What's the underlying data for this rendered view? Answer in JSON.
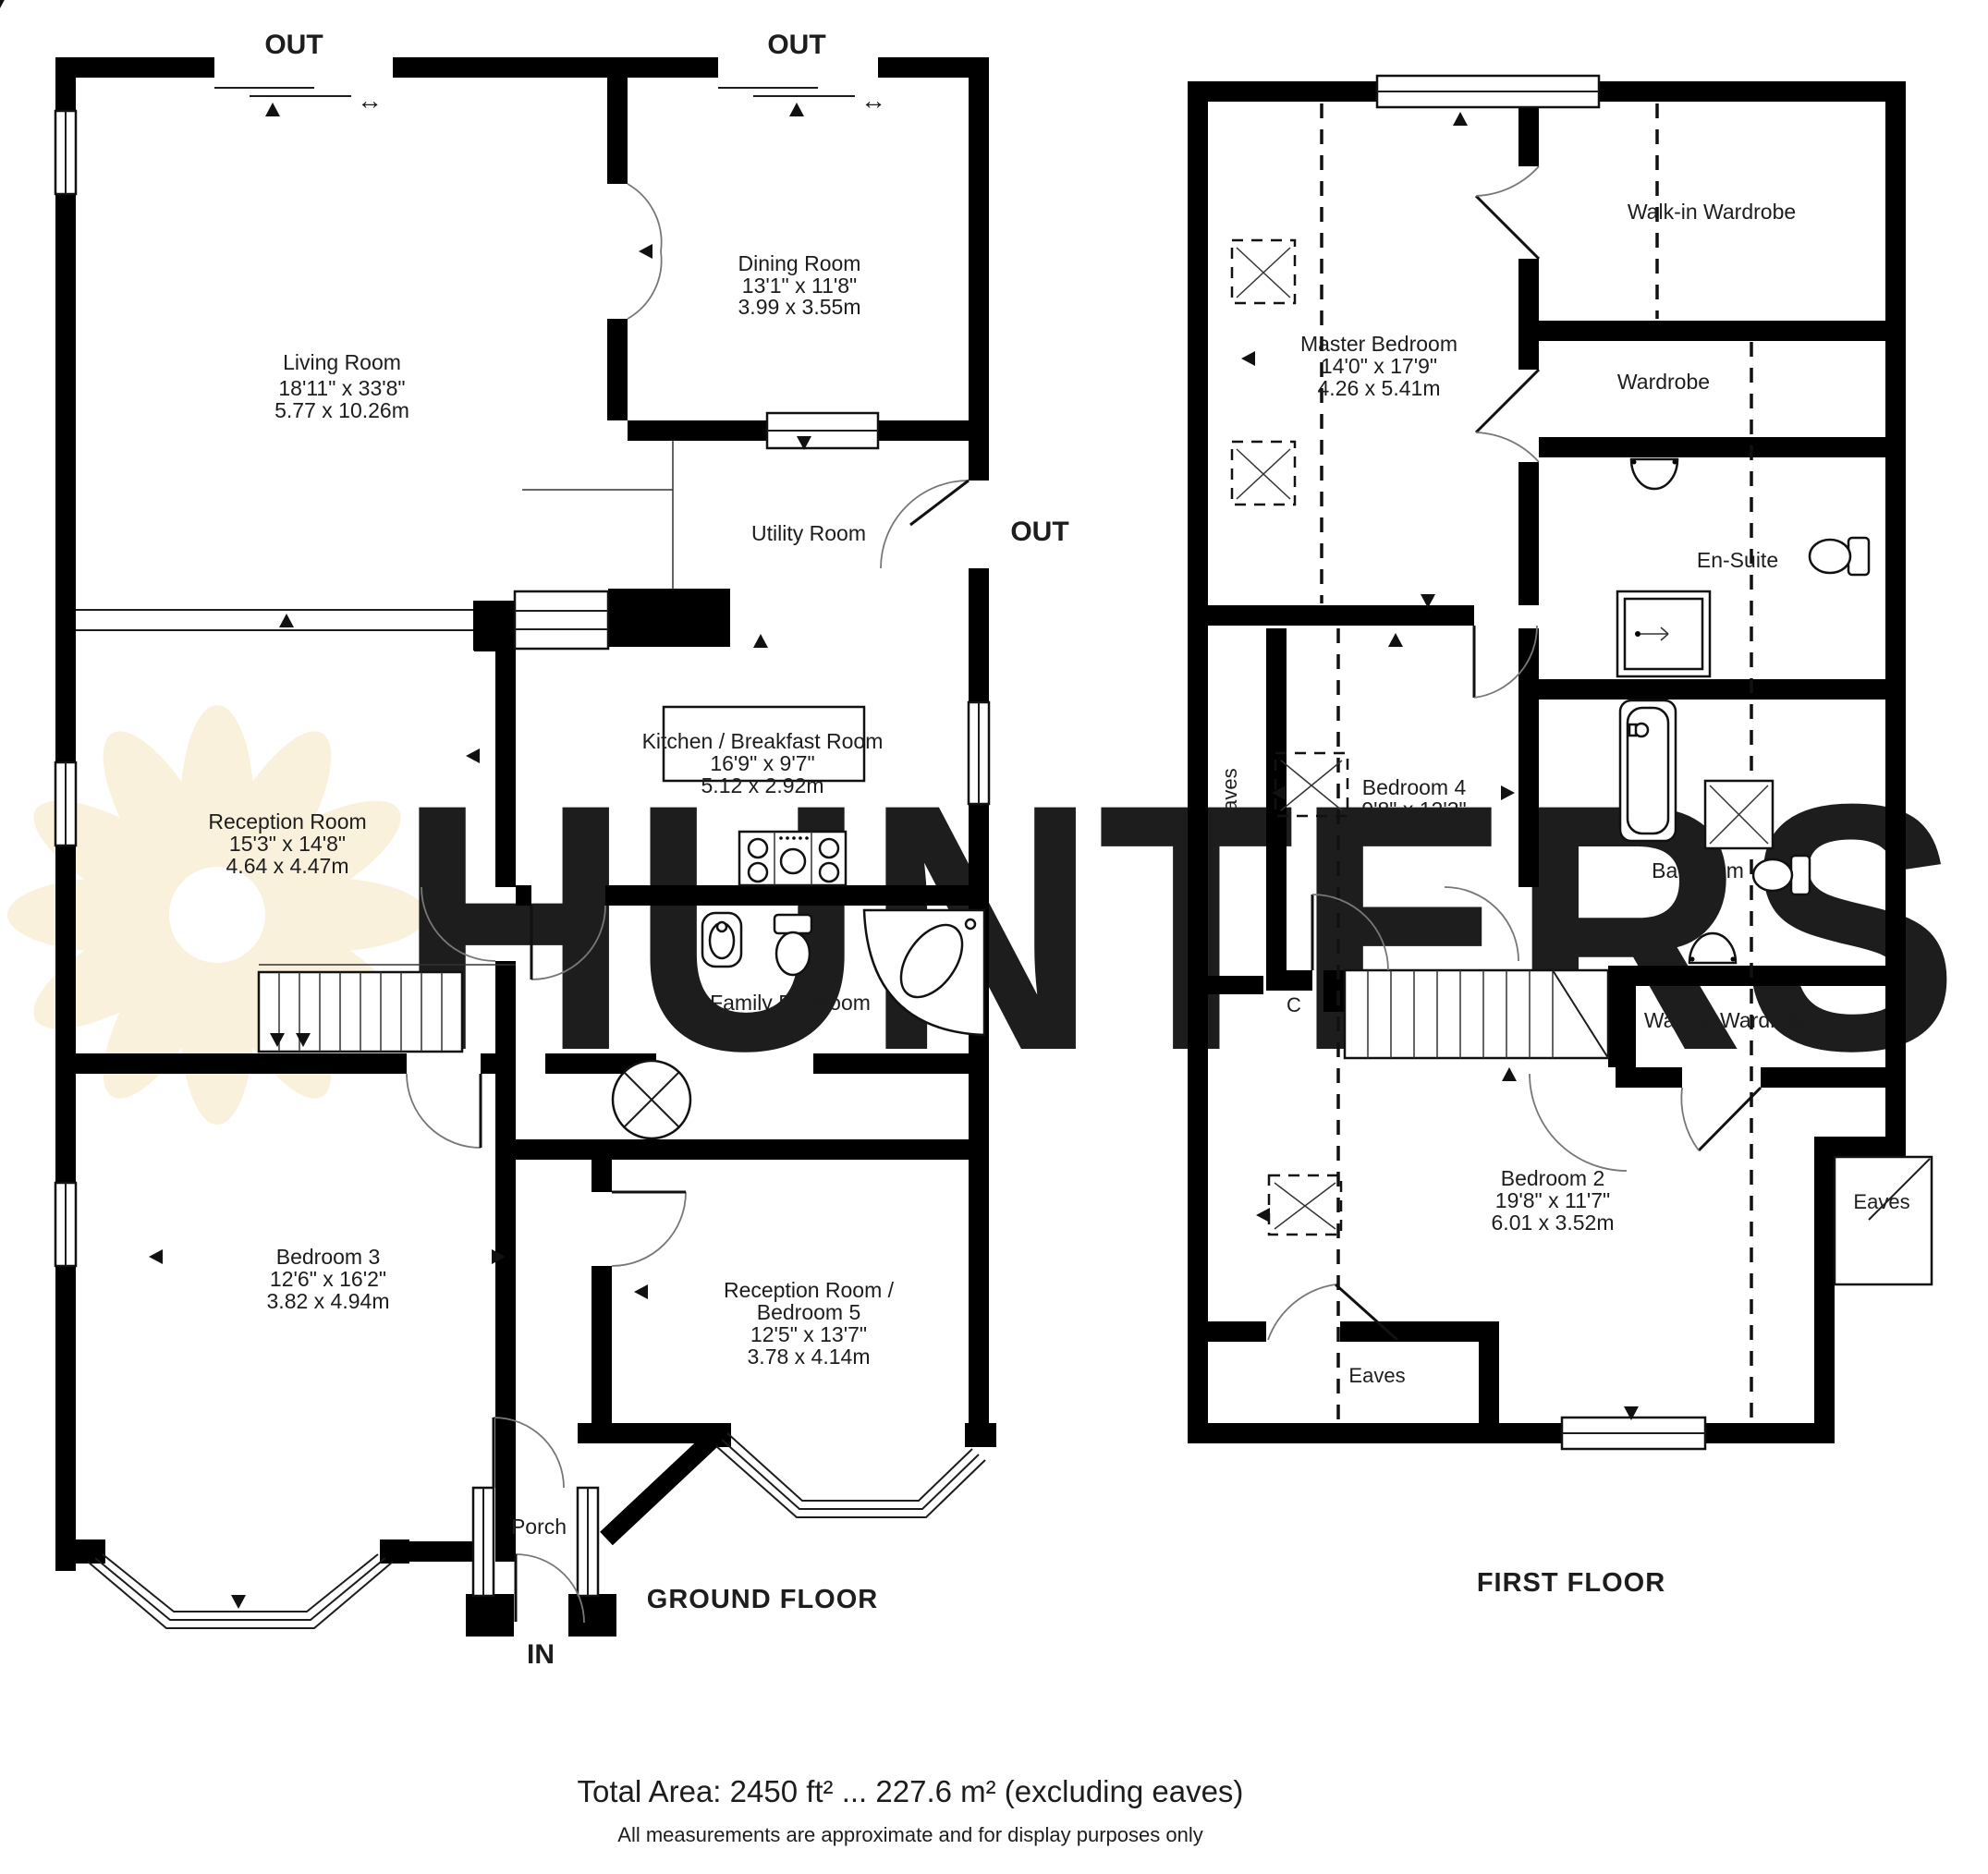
{
  "watermark": {
    "brand": "HUNTERS"
  },
  "ground_floor": {
    "title": "GROUND FLOOR",
    "door_labels": {
      "out_top_left": "OUT",
      "out_top_right": "OUT",
      "out_side": "OUT",
      "in_label": "IN"
    },
    "rooms": [
      {
        "name": "Living Room",
        "imperial": "18'11\" x 33'8\"",
        "metric": "5.77 x 10.26m"
      },
      {
        "name": "Dining Room",
        "imperial": "13'1\" x 11'8\"",
        "metric": "3.99 x 3.55m"
      },
      {
        "name": "Utility Room"
      },
      {
        "name": "Kitchen / Breakfast Room",
        "imperial": "16'9\" x 9'7\"",
        "metric": "5.12 x 2.92m"
      },
      {
        "name": "Reception Room",
        "imperial": "15'3\" x 14'8\"",
        "metric": "4.64 x 4.47m"
      },
      {
        "name": "Family Bathroom"
      },
      {
        "name": "Bedroom 3",
        "imperial": "12'6\" x 16'2\"",
        "metric": "3.82 x 4.94m"
      },
      {
        "name": "Reception Room /",
        "name2": "Bedroom 5",
        "imperial": "12'5\" x 13'7\"",
        "metric": "3.78 x 4.14m"
      },
      {
        "name": "Porch"
      }
    ]
  },
  "first_floor": {
    "title": "FIRST FLOOR",
    "rooms": [
      {
        "name": "Master Bedroom",
        "imperial": "14'0\" x 17'9\"",
        "metric": "4.26 x 5.41m"
      },
      {
        "name": "Walk-in Wardrobe"
      },
      {
        "name": "Wardrobe"
      },
      {
        "name": "En-Suite"
      },
      {
        "name": "Bedroom 4",
        "imperial": "9'8\" x 12'3\"",
        "metric": "2.93 x 3.75m"
      },
      {
        "name": "Bathroom"
      },
      {
        "name": "Walk-in Wardrobe"
      },
      {
        "name": "Bedroom 2",
        "imperial": "19'8\" x 11'7\"",
        "metric": "6.01 x 3.52m"
      }
    ],
    "annotations": {
      "eaves_left": "Eaves",
      "eaves_right": "Eaves",
      "eaves_bottom": "Eaves",
      "cupboard": "C"
    }
  },
  "footer": {
    "total_area": "Total Area: 2450 ft² ... 227.6 m² (excluding eaves)",
    "disclaimer": "All measurements are approximate and for display purposes only"
  }
}
